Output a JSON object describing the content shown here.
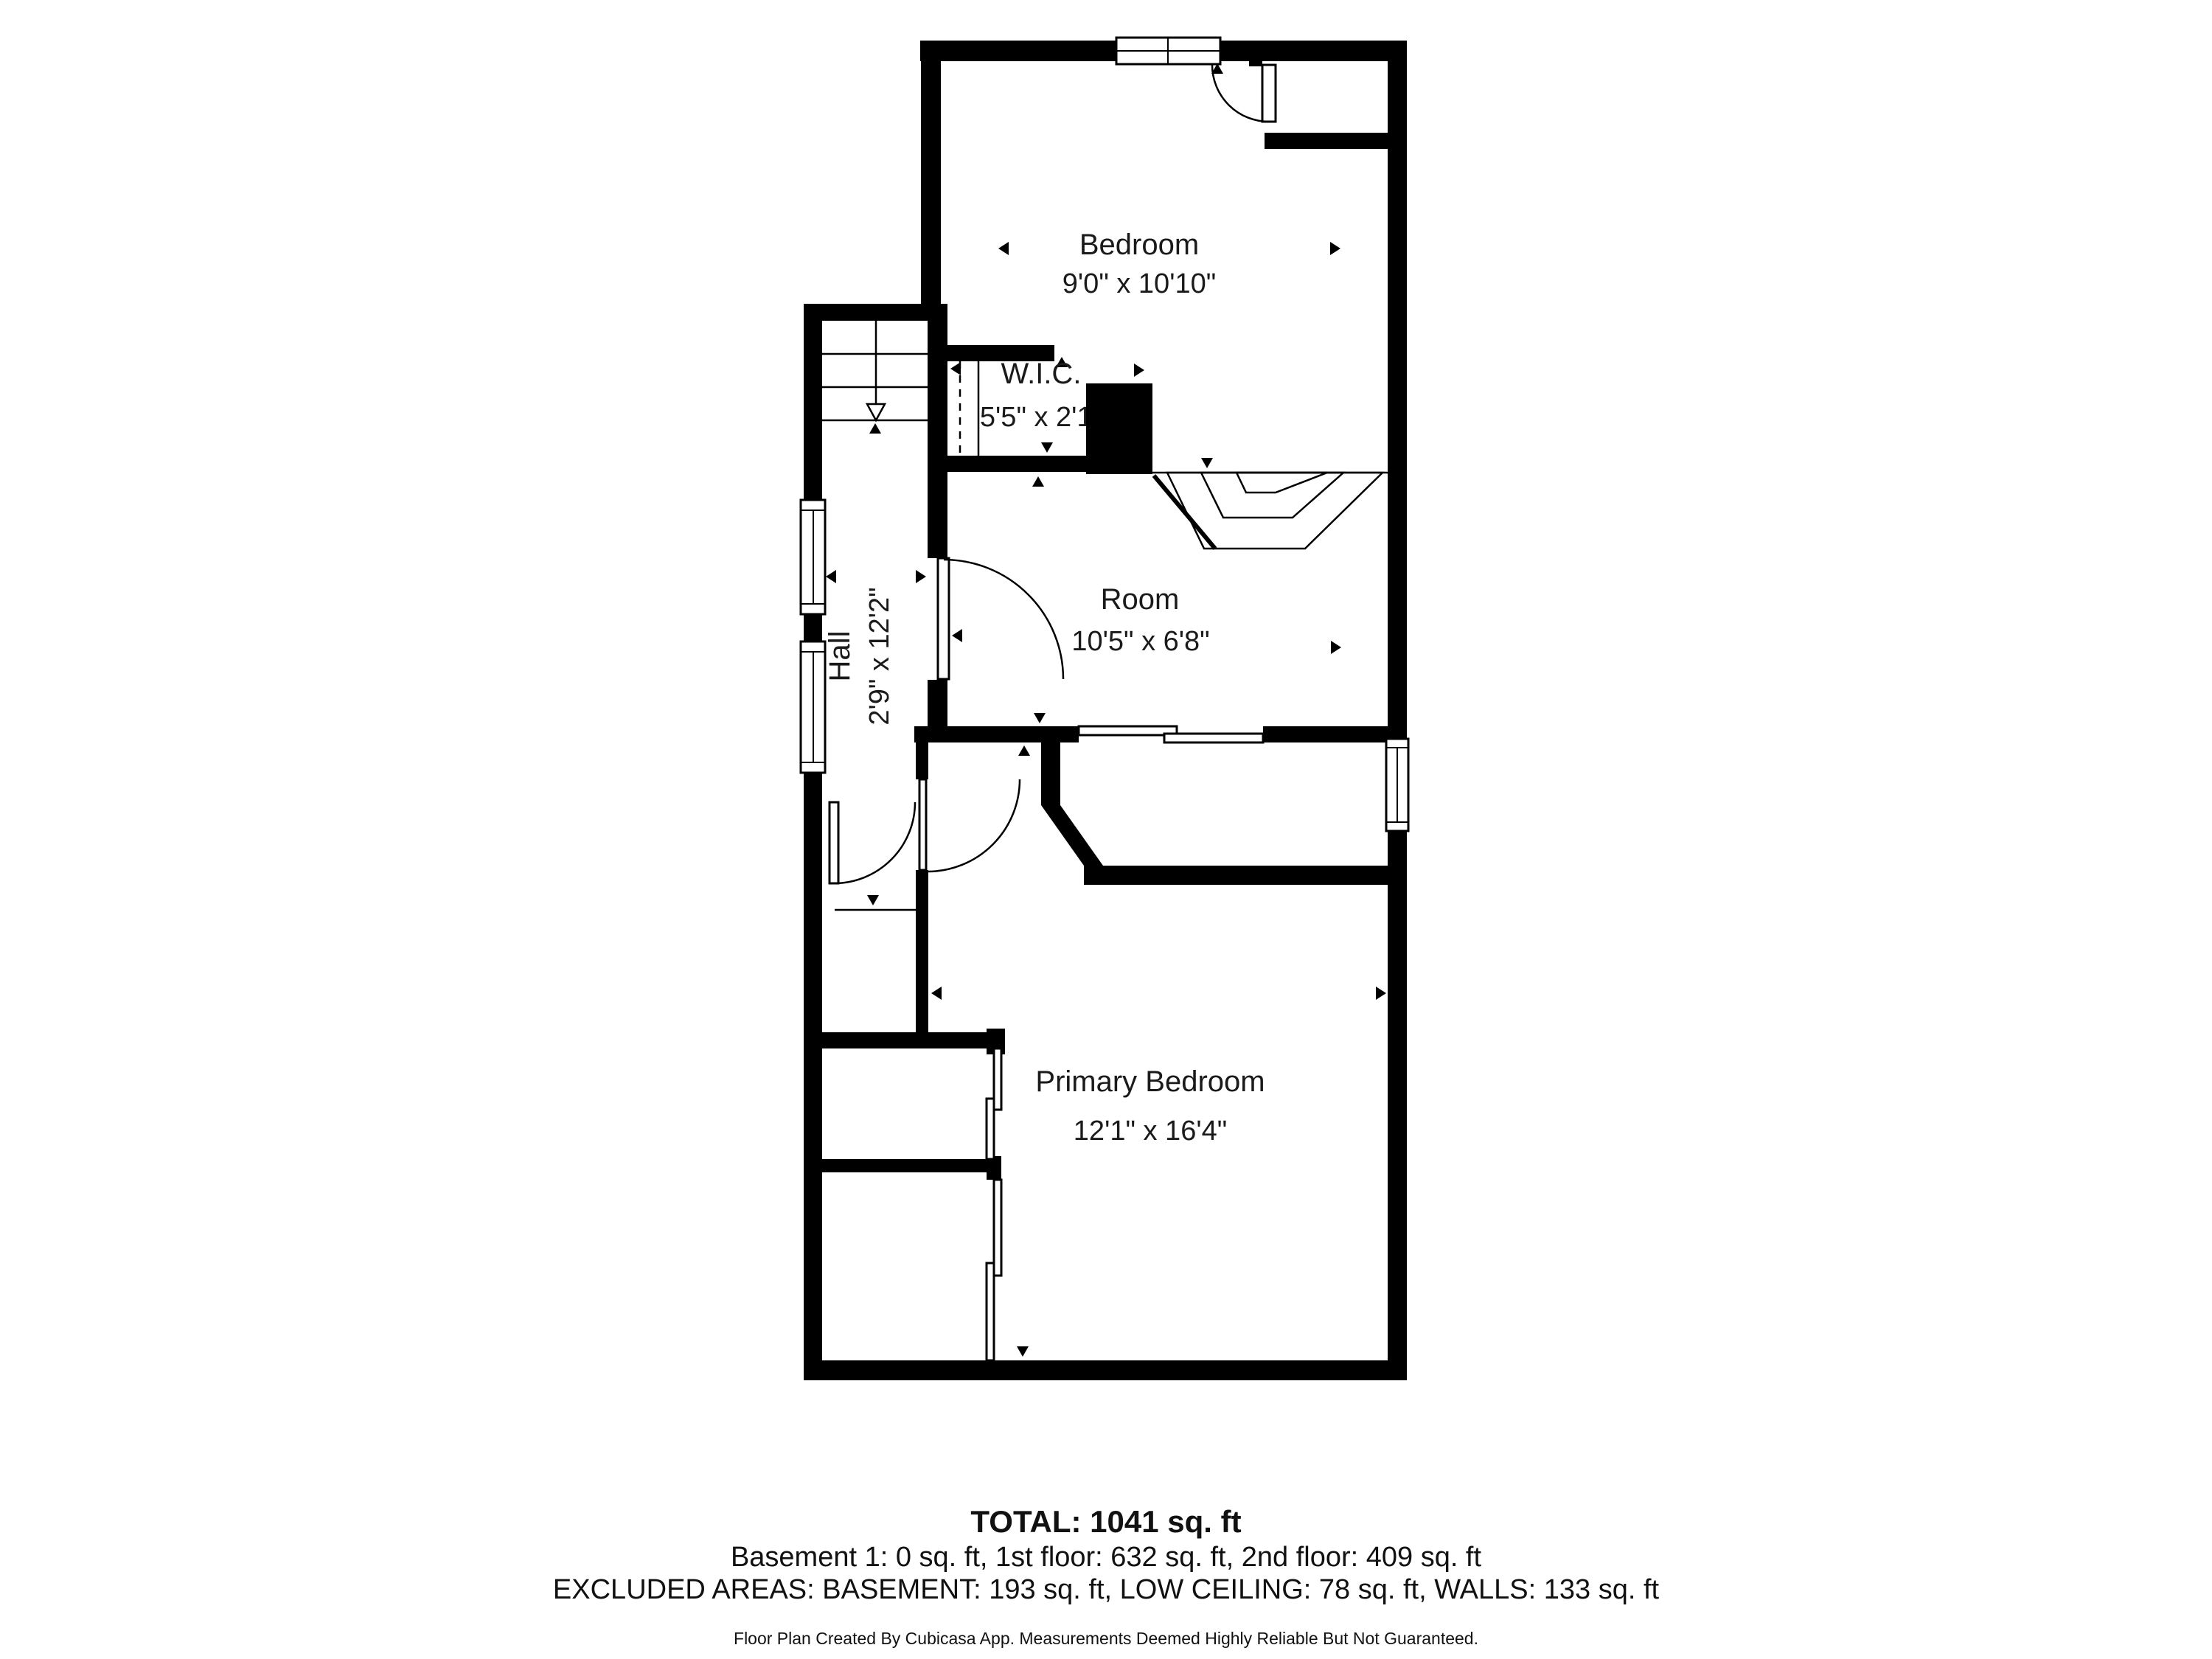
{
  "plan": {
    "floor_name": "2nd floor",
    "rooms": {
      "bedroom": {
        "name": "Bedroom",
        "dims": "9'0\" x 10'10\""
      },
      "wic": {
        "name": "W.I.C.",
        "dims": "5'5\" x 2'1\""
      },
      "room": {
        "name": "Room",
        "dims": "10'5\" x 6'8\""
      },
      "hall": {
        "name": "Hall",
        "dims": "2'9\" x 12'2\""
      },
      "primary": {
        "name": "Primary Bedroom",
        "dims": "12'1\" x 16'4\""
      }
    }
  },
  "summary": {
    "total": "TOTAL: 1041 sq. ft",
    "floors": "Basement 1: 0 sq. ft, 1st floor: 632 sq. ft, 2nd floor: 409 sq. ft",
    "excluded": "EXCLUDED AREAS: BASEMENT: 193 sq. ft, LOW CEILING: 78 sq. ft, WALLS: 133 sq. ft"
  },
  "footer": {
    "disclaimer": "Floor Plan Created By Cubicasa App. Measurements Deemed Highly Reliable But Not Guaranteed."
  },
  "colors": {
    "wall": "#000000",
    "background": "#ffffff",
    "text": "#111111"
  }
}
